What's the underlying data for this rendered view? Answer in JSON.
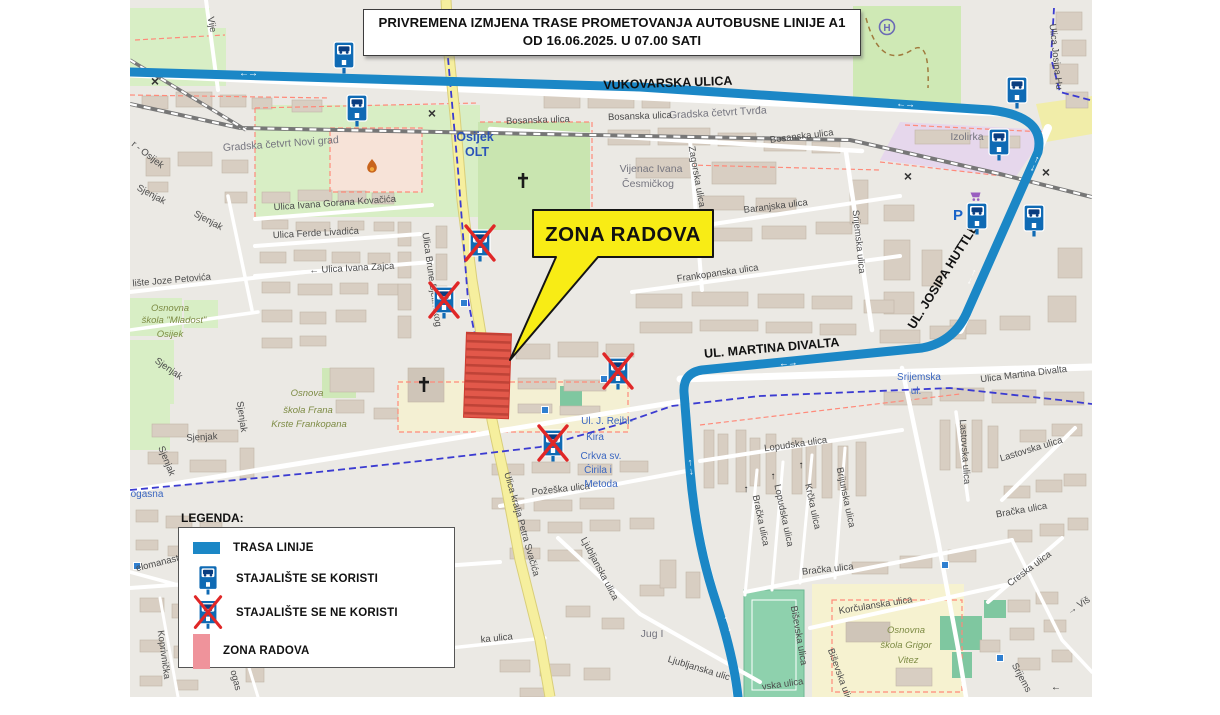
{
  "title": {
    "line1": "PRIVREMENA IZMJENA TRASE PROMETOVANJA AUTOBUSNE LINIJE A1",
    "line2": "OD 16.06.2025. U 07.00 SATI"
  },
  "callout": {
    "text": "ZONA RADOVA"
  },
  "legend": {
    "heading": "LEGENDA:",
    "items": [
      {
        "type": "route-line",
        "label": "TRASA LINIJE"
      },
      {
        "type": "stop-used",
        "label": "STAJALIŠTE SE KORISTI"
      },
      {
        "type": "stop-closed",
        "label": "STAJALIŠTE SE NE KORISTI"
      },
      {
        "type": "work-zone",
        "label": "ZONA RADOVA"
      }
    ]
  },
  "colors": {
    "route_blue": "#1b87c6",
    "stop_sign_blue": "#0f6ab4",
    "cross_red": "#e02727",
    "zone_red": "#e2584a",
    "zone_legend_pink": "#ef939b",
    "callout_yellow": "#f8ec15"
  },
  "map": {
    "labels": [
      {
        "text": "VUKOVARSKA ULICA",
        "x": 668,
        "y": 87,
        "rot": -2,
        "cls": "route"
      },
      {
        "text": "UL. MARTINA DIVALTA",
        "x": 772,
        "y": 352,
        "rot": -5,
        "cls": "route"
      },
      {
        "text": "UL. JOSIPA HUTTLERA",
        "x": 951,
        "y": 271,
        "rot": -58,
        "cls": "route"
      },
      {
        "text": "Gradska četvrt Tvrđa",
        "x": 718,
        "y": 116,
        "rot": -3,
        "cls": "district"
      },
      {
        "text": "Gradska četvrt Novi grad",
        "x": 281,
        "y": 147,
        "rot": -4,
        "cls": "district"
      },
      {
        "text": "Vijenac Ivana",
        "x": 651,
        "y": 172,
        "rot": 0,
        "cls": "district"
      },
      {
        "text": "Česmičkog",
        "x": 648,
        "y": 187,
        "rot": 0,
        "cls": "district"
      },
      {
        "text": "Izolirka",
        "x": 967,
        "y": 140,
        "rot": 0,
        "cls": "district"
      },
      {
        "text": "Jug I",
        "x": 652,
        "y": 637,
        "rot": 0,
        "cls": "district"
      },
      {
        "text": "Osijek",
        "x": 475,
        "y": 141,
        "rot": 0,
        "cls": "place"
      },
      {
        "text": "OLT",
        "x": 477,
        "y": 156,
        "rot": 0,
        "cls": "place"
      },
      {
        "text": "Bosanska ulica",
        "x": 538,
        "y": 123,
        "rot": -2,
        "cls": "street"
      },
      {
        "text": "Bosanska ulica",
        "x": 640,
        "y": 119,
        "rot": -2,
        "cls": "street"
      },
      {
        "text": "Bosanska ulica",
        "x": 802,
        "y": 139,
        "rot": -7,
        "cls": "street"
      },
      {
        "text": "Zagorska ulica",
        "x": 694,
        "y": 177,
        "rot": 80,
        "cls": "street"
      },
      {
        "text": "Baranjska ulica",
        "x": 776,
        "y": 209,
        "rot": -7,
        "cls": "street"
      },
      {
        "text": "Srijemska ulica",
        "x": 856,
        "y": 242,
        "rot": 84,
        "cls": "street"
      },
      {
        "text": "Frankopanska ulica",
        "x": 718,
        "y": 276,
        "rot": -8,
        "cls": "street"
      },
      {
        "text": "Ulica Ivana Gorana Kovačića",
        "x": 335,
        "y": 206,
        "rot": -4,
        "cls": "street"
      },
      {
        "text": "Ulica Ferde Livadića",
        "x": 316,
        "y": 236,
        "rot": -3,
        "cls": "street"
      },
      {
        "text": "← Ulica Ivana Zajca",
        "x": 352,
        "y": 271,
        "rot": -3,
        "cls": "street"
      },
      {
        "text": "lište Joze Petovića",
        "x": 172,
        "y": 283,
        "rot": -5,
        "cls": "street"
      },
      {
        "text": "Sjenjak",
        "x": 150,
        "y": 197,
        "rot": 28,
        "cls": "street"
      },
      {
        "text": "Sjenjak",
        "x": 207,
        "y": 223,
        "rot": 28,
        "cls": "street"
      },
      {
        "text": "Sjenjak",
        "x": 167,
        "y": 371,
        "rot": 35,
        "cls": "street"
      },
      {
        "text": "Sjenjak",
        "x": 239,
        "y": 417,
        "rot": 82,
        "cls": "street"
      },
      {
        "text": "Sjenjak",
        "x": 202,
        "y": 440,
        "rot": -3,
        "cls": "street"
      },
      {
        "text": "Sjenjak",
        "x": 164,
        "y": 462,
        "rot": 68,
        "cls": "street"
      },
      {
        "text": "Ulica Brune Bjelinskog",
        "x": 429,
        "y": 280,
        "rot": 82,
        "cls": "street"
      },
      {
        "text": "Ulica kralja Petra Svačića",
        "x": 519,
        "y": 525,
        "rot": 74,
        "cls": "street"
      },
      {
        "text": "r - Osijek",
        "x": 146,
        "y": 157,
        "rot": 38,
        "cls": "street"
      },
      {
        "text": "Vije",
        "x": 209,
        "y": 25,
        "rot": 80,
        "cls": "street"
      },
      {
        "text": "Ulica Josipa Hu",
        "x": 1053,
        "y": 57,
        "rot": 84,
        "cls": "street"
      },
      {
        "text": "Ulica Martina Divalta",
        "x": 1024,
        "y": 377,
        "rot": -7,
        "cls": "street"
      },
      {
        "text": "Požeška ulica",
        "x": 561,
        "y": 492,
        "rot": -6,
        "cls": "street"
      },
      {
        "text": "Ljubljanska ulica",
        "x": 597,
        "y": 570,
        "rot": 62,
        "cls": "street"
      },
      {
        "text": "Ljubljanska ulic",
        "x": 698,
        "y": 671,
        "rot": 17,
        "cls": "street"
      },
      {
        "text": "Lopudska ulica",
        "x": 796,
        "y": 447,
        "rot": -8,
        "cls": "street"
      },
      {
        "text": "Bračka ulica",
        "x": 758,
        "y": 521,
        "rot": 78,
        "cls": "street"
      },
      {
        "text": "Lopudska ulica",
        "x": 781,
        "y": 516,
        "rot": 78,
        "cls": "street"
      },
      {
        "text": "Krčka ulica",
        "x": 810,
        "y": 507,
        "rot": 78,
        "cls": "street"
      },
      {
        "text": "Brijunska ulica",
        "x": 843,
        "y": 498,
        "rot": 78,
        "cls": "street"
      },
      {
        "text": "Bračka ulica",
        "x": 828,
        "y": 572,
        "rot": -6,
        "cls": "street"
      },
      {
        "text": "Lastovska ulica",
        "x": 962,
        "y": 452,
        "rot": 86,
        "cls": "street"
      },
      {
        "text": "Lastovska ulica",
        "x": 1032,
        "y": 452,
        "rot": -17,
        "cls": "street"
      },
      {
        "text": "Bračka ulica",
        "x": 1022,
        "y": 513,
        "rot": -10,
        "cls": "street"
      },
      {
        "text": "Creska ulica",
        "x": 1031,
        "y": 571,
        "rot": -37,
        "cls": "street"
      },
      {
        "text": "→ Viš",
        "x": 1080,
        "y": 608,
        "rot": -33,
        "cls": "street"
      },
      {
        "text": "Srijems",
        "x": 1019,
        "y": 679,
        "rot": 62,
        "cls": "street"
      },
      {
        "text": "Korčulanska ulica",
        "x": 876,
        "y": 608,
        "rot": -9,
        "cls": "street"
      },
      {
        "text": "Biševska ulica",
        "x": 796,
        "y": 636,
        "rot": 80,
        "cls": "street"
      },
      {
        "text": "Biševska ulica",
        "x": 838,
        "y": 678,
        "rot": 70,
        "cls": "street"
      },
      {
        "text": "vska ulica",
        "x": 783,
        "y": 687,
        "rot": -8,
        "cls": "street"
      },
      {
        "text": "elomanast",
        "x": 158,
        "y": 566,
        "rot": -14,
        "cls": "street"
      },
      {
        "text": "Koprivnička",
        "x": 161,
        "y": 655,
        "rot": 82,
        "cls": "street"
      },
      {
        "text": "ka ulica",
        "x": 497,
        "y": 641,
        "rot": -6,
        "cls": "street"
      },
      {
        "text": "ogas",
        "x": 233,
        "y": 681,
        "rot": 75,
        "cls": "street"
      },
      {
        "text": "Osnovna",
        "x": 170,
        "y": 311,
        "rot": 0,
        "cls": "school"
      },
      {
        "text": "škola \"Mladost\"",
        "x": 174,
        "y": 323,
        "rot": 0,
        "cls": "school"
      },
      {
        "text": "Osijek",
        "x": 170,
        "y": 337,
        "rot": 0,
        "cls": "school"
      },
      {
        "text": "Osnova",
        "x": 307,
        "y": 396,
        "rot": 0,
        "cls": "school"
      },
      {
        "text": "škola Frana",
        "x": 308,
        "y": 413,
        "rot": 0,
        "cls": "school"
      },
      {
        "text": "Krste Frankopana",
        "x": 309,
        "y": 427,
        "rot": 0,
        "cls": "school"
      },
      {
        "text": "Osnovna",
        "x": 906,
        "y": 633,
        "rot": 0,
        "cls": "school"
      },
      {
        "text": "škola Grigor",
        "x": 906,
        "y": 648,
        "rot": 0,
        "cls": "school"
      },
      {
        "text": "Vitez",
        "x": 908,
        "y": 663,
        "rot": 0,
        "cls": "school"
      },
      {
        "text": "Srijemska",
        "x": 919,
        "y": 380,
        "rot": 0,
        "cls": "blue"
      },
      {
        "text": "ul.",
        "x": 916,
        "y": 394,
        "rot": 0,
        "cls": "blue"
      },
      {
        "text": "Ul. J. Reihl-",
        "x": 607,
        "y": 424,
        "rot": 0,
        "cls": "blue"
      },
      {
        "text": "Kira",
        "x": 595,
        "y": 440,
        "rot": 0,
        "cls": "blue"
      },
      {
        "text": "Crkva sv.",
        "x": 601,
        "y": 459,
        "rot": 0,
        "cls": "blue"
      },
      {
        "text": "Ćirila i",
        "x": 598,
        "y": 473,
        "rot": 0,
        "cls": "blue"
      },
      {
        "text": "Metoda",
        "x": 601,
        "y": 487,
        "rot": 0,
        "cls": "blue"
      },
      {
        "text": "ogasna",
        "x": 147,
        "y": 497,
        "rot": 0,
        "cls": "blue"
      },
      {
        "text": "↑",
        "x": 746,
        "y": 492,
        "rot": 0,
        "cls": "oneway"
      },
      {
        "text": "↑",
        "x": 773,
        "y": 479,
        "rot": 0,
        "cls": "oneway"
      },
      {
        "text": "↑",
        "x": 801,
        "y": 468,
        "rot": 0,
        "cls": "oneway"
      },
      {
        "text": "←",
        "x": 1056,
        "y": 690,
        "rot": 0,
        "cls": "oneway"
      }
    ],
    "stops": [
      {
        "x": 344,
        "y": 55,
        "closed": false
      },
      {
        "x": 357,
        "y": 108,
        "closed": false
      },
      {
        "x": 1017,
        "y": 90,
        "closed": false
      },
      {
        "x": 999,
        "y": 142,
        "closed": false
      },
      {
        "x": 977,
        "y": 216,
        "closed": false
      },
      {
        "x": 1034,
        "y": 218,
        "closed": false
      },
      {
        "x": 480,
        "y": 243,
        "closed": true
      },
      {
        "x": 444,
        "y": 300,
        "closed": true
      },
      {
        "x": 618,
        "y": 371,
        "closed": true
      },
      {
        "x": 553,
        "y": 443,
        "closed": true
      }
    ],
    "route_arrows": [
      {
        "x": 248,
        "y": 76,
        "rot": 1
      },
      {
        "x": 905,
        "y": 107,
        "rot": 4
      },
      {
        "x": 1036,
        "y": 165,
        "rot": -66
      },
      {
        "x": 973,
        "y": 278,
        "rot": -66
      },
      {
        "x": 788,
        "y": 366,
        "rot": -4
      },
      {
        "x": 689,
        "y": 467,
        "rot": 84
      },
      {
        "x": 726,
        "y": 624,
        "rot": 72
      }
    ],
    "railway_crossings": [
      {
        "x": 155,
        "y": 86
      },
      {
        "x": 432,
        "y": 118
      },
      {
        "x": 908,
        "y": 181
      },
      {
        "x": 1046,
        "y": 177
      }
    ],
    "minor_stop_squares": [
      {
        "x": 545,
        "y": 410
      },
      {
        "x": 604,
        "y": 379
      },
      {
        "x": 945,
        "y": 565
      },
      {
        "x": 1000,
        "y": 658
      },
      {
        "x": 137,
        "y": 566
      },
      {
        "x": 464,
        "y": 303
      }
    ],
    "pois": [
      {
        "type": "hospital-helipad",
        "x": 887,
        "y": 27
      },
      {
        "type": "fire-station",
        "x": 372,
        "y": 167
      },
      {
        "type": "church-cross",
        "x": 523,
        "y": 181
      },
      {
        "type": "church-cross",
        "x": 424,
        "y": 385
      },
      {
        "type": "parking",
        "x": 958,
        "y": 220,
        "label": "P"
      },
      {
        "type": "supermarket",
        "x": 976,
        "y": 196
      }
    ]
  }
}
